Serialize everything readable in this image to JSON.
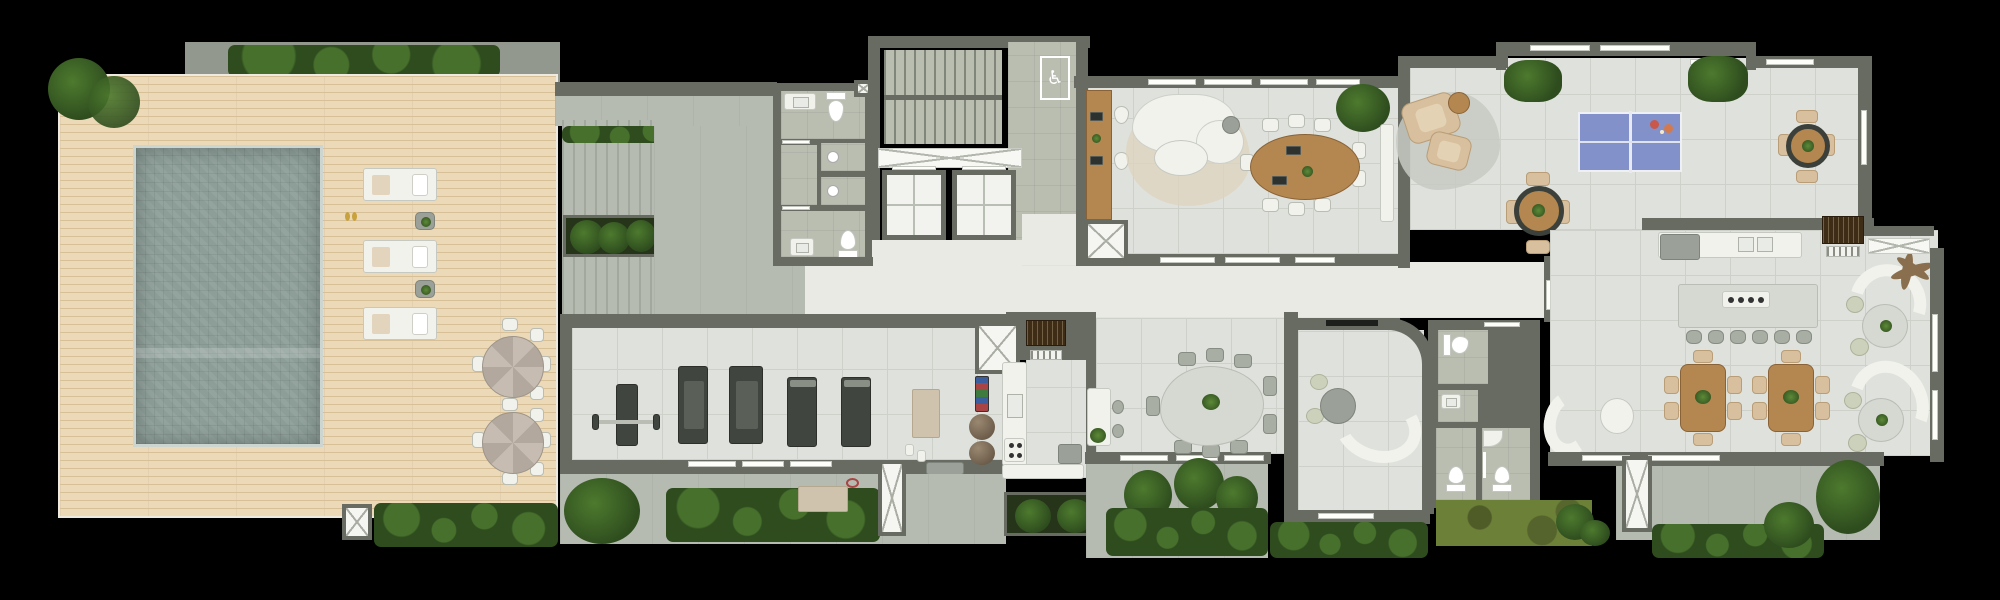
{
  "meta": {
    "view": "top-down architectural floor plan render",
    "floor": "residential amenities level",
    "canvas_px": {
      "width": 2000,
      "height": 600
    }
  },
  "icons": {
    "wheelchair_accessible": "♿"
  },
  "palette": {
    "background": "#000000",
    "wall": "#676b62",
    "walkway": "#93988e",
    "deck_wood": "#ebd9b7",
    "deck_line": "#d7c097",
    "pool_water": "#8d9e98",
    "pool_coping": "#ccd5cf",
    "terrace": "#b6bbb2",
    "pergola_stripe": "#a3a89f",
    "tile_indoor": "#dfe2dc",
    "tile_grid": "#cdd1ca",
    "tile_core": "#b9beb1",
    "marble": "#e9eae4",
    "hedge_dark": "#2e4c1e",
    "hedge_mid": "#47702c",
    "plant_green": "#4d7a2e",
    "lawn": "#6d8038",
    "soil_planter": "#26341a",
    "furniture_white": "#f2f2ed",
    "furniture_grey": "#9ba098",
    "stone_top": "#d6d9d2",
    "wood": "#b3874f",
    "wood_dark": "#8a6238",
    "beige": "#d8bf9e",
    "equip_dark": "#41453f",
    "pingpong_blue": "#8291c9",
    "paddle_red": "#c9574a",
    "grill_brown": "#3e2c16"
  },
  "areas": [
    {
      "id": "pool-deck",
      "label": "Pool deck"
    },
    {
      "id": "swimming-pool",
      "label": "Swimming pool"
    },
    {
      "id": "pergola",
      "label": "Pergola walk"
    },
    {
      "id": "gym",
      "label": "Gym"
    },
    {
      "id": "showers-wc",
      "label": "Showers and WC"
    },
    {
      "id": "stair-hall",
      "label": "Stair hall"
    },
    {
      "id": "elevators",
      "label": "Elevators"
    },
    {
      "id": "coworking",
      "label": "Coworking / meeting lounge"
    },
    {
      "id": "games-room",
      "label": "Games room"
    },
    {
      "id": "kitchen",
      "label": "Kitchen"
    },
    {
      "id": "dining-room",
      "label": "Dining room"
    },
    {
      "id": "tv-lounge",
      "label": "TV lounge"
    },
    {
      "id": "restrooms",
      "label": "Restrooms"
    },
    {
      "id": "party-room",
      "label": "Gourmet party room"
    },
    {
      "id": "garden-terraces",
      "label": "Garden terraces"
    }
  ]
}
